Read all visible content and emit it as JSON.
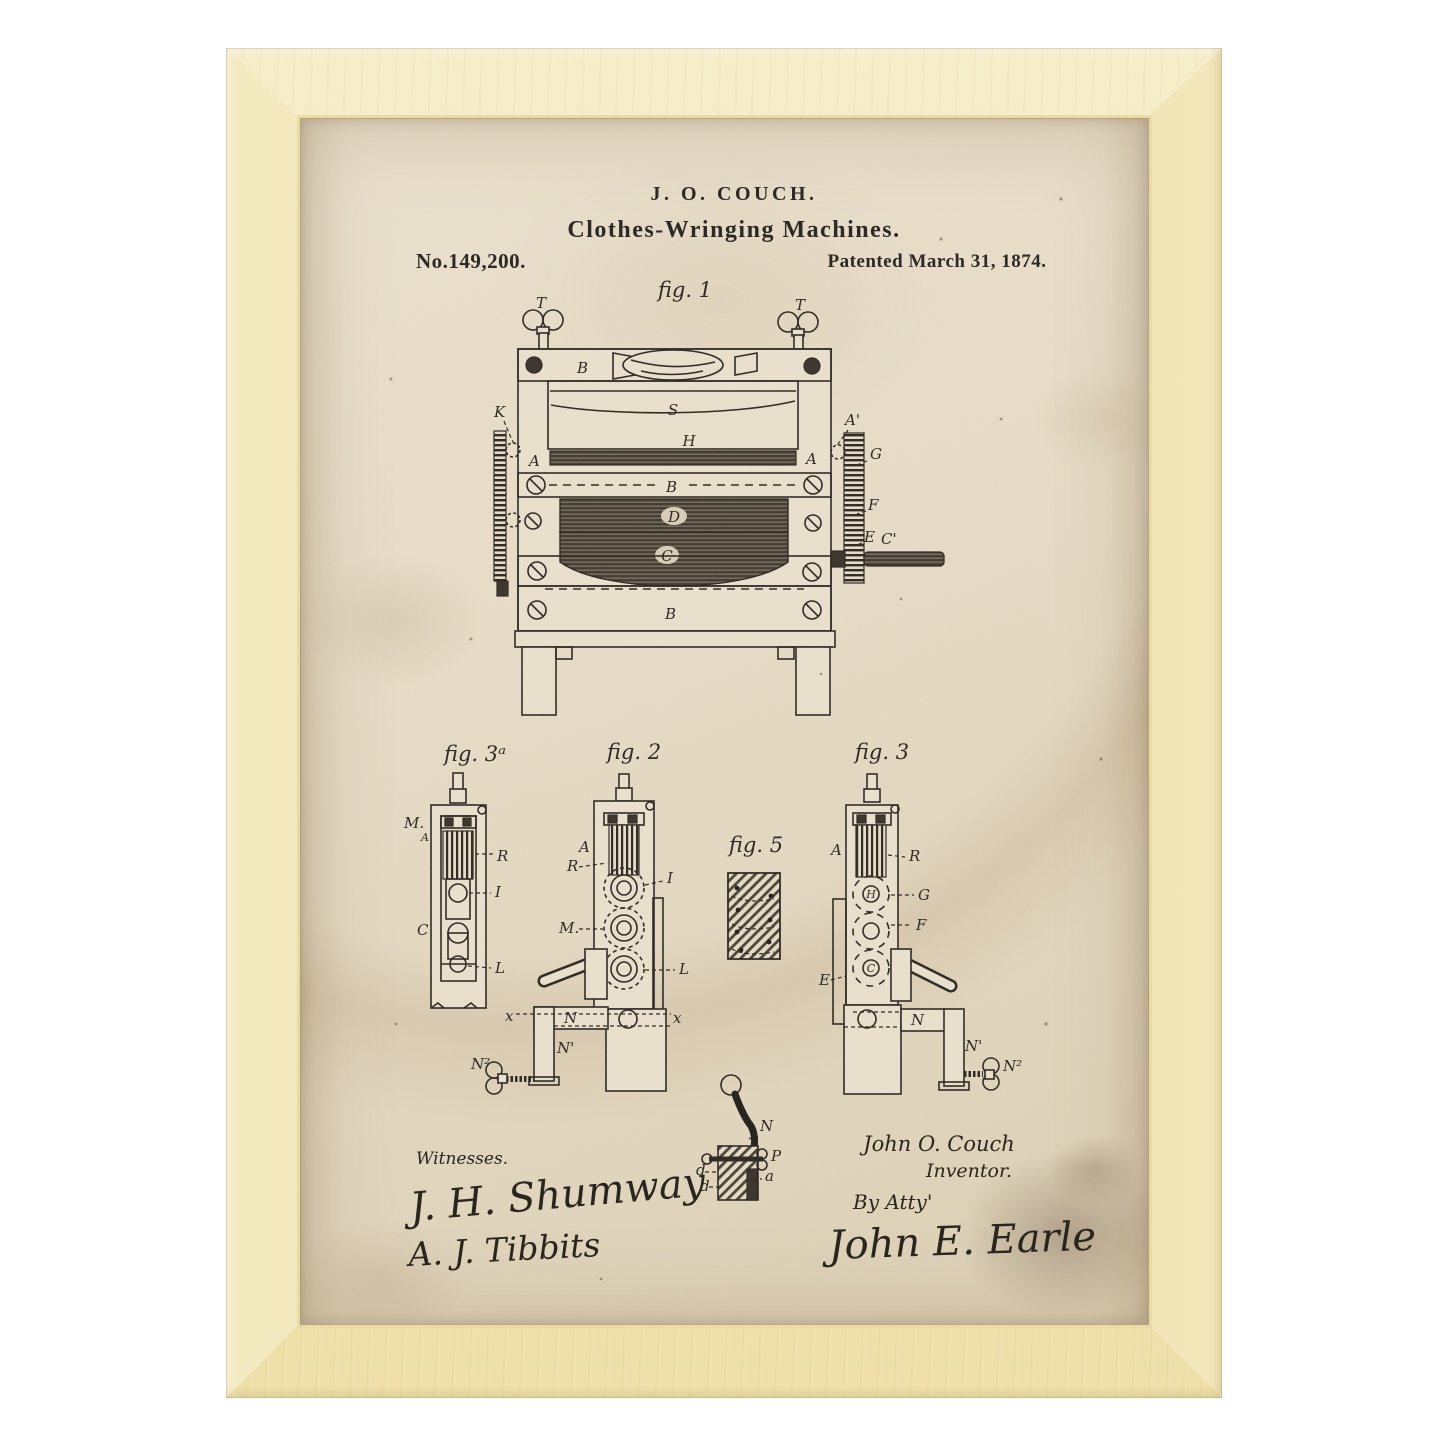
{
  "artwork": {
    "frame_color": "#f0e3b0",
    "paper_color": "#e7ddc8",
    "ink_color": "#2b2620"
  },
  "patent": {
    "header": {
      "inventor_line": "J. O. COUCH.",
      "title_line": "Clothes-Wringing Machines.",
      "patent_number": "No.149,200.",
      "patent_date": "Patented March 31, 1874."
    },
    "figures": {
      "fig1": {
        "caption": "fig. 1",
        "labels": {
          "t_left": "T",
          "t_right": "T",
          "b_top": "B",
          "s": "S",
          "h": "H",
          "a_left": "A",
          "a_right": "A",
          "k_left": "K",
          "a_prime": "A'",
          "g": "G",
          "f": "F",
          "e": "E",
          "c_prime": "C'",
          "b_mid": "B",
          "d": "D",
          "c": "C",
          "b_lower": "B"
        }
      },
      "fig3a": {
        "caption": "fig. 3ᵃ",
        "labels": {
          "m": "M.",
          "a": "A",
          "r": "R",
          "i": "I",
          "c": "C",
          "l": "L"
        }
      },
      "fig2": {
        "caption": "fig. 2",
        "labels": {
          "a": "A",
          "r": "R",
          "i": "I",
          "m": "M.",
          "l": "L",
          "x_left": "x",
          "n": "N",
          "x_right": "x",
          "n_prime": "N'",
          "n_two": "N²"
        }
      },
      "fig5": {
        "caption": "fig. 5"
      },
      "fig3": {
        "caption": "fig. 3",
        "labels": {
          "a": "A",
          "r": "R",
          "h": "H",
          "g": "G",
          "f": "F",
          "c": "C",
          "e": "E",
          "n": "N",
          "n_prime": "N'",
          "n_two": "N²"
        }
      },
      "fig4": {
        "labels": {
          "n": "N",
          "p": "P",
          "d1": "d",
          "d2": "d",
          "a": "a"
        }
      }
    },
    "footer": {
      "witnesses_heading": "Witnesses.",
      "witness_signature_1": "J. H. Shumway",
      "witness_signature_2": "A. J. Tibbits",
      "inventor_signature": "John O. Couch",
      "inventor_title": "Inventor.",
      "by_attorney": "By Atty'",
      "attorney_signature": "John E. Earle"
    }
  }
}
